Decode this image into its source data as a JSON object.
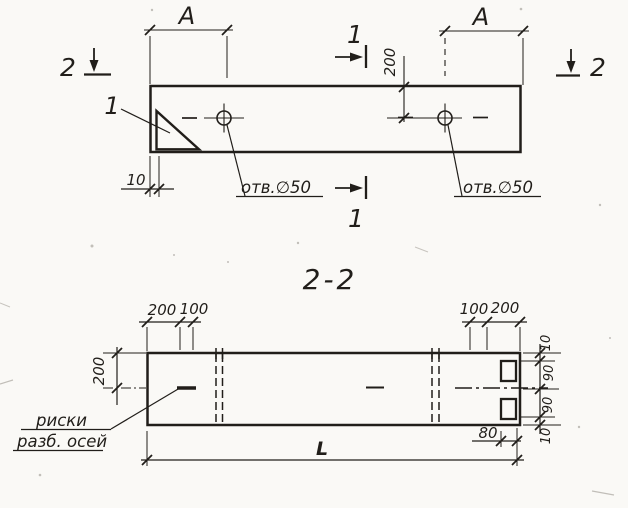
{
  "palette": {
    "paper": "#faf9f6",
    "ink": "#211e1a"
  },
  "plan_view": {
    "span_label_left": "А",
    "span_label_right": "А",
    "detail_mark": "1",
    "section_mark_1_top": "1",
    "section_mark_1_bottom": "1",
    "section_mark_2_left": "2",
    "section_mark_2_right": "2",
    "dim_axis_offset": "200",
    "dim_end_offset": "10",
    "hole_note_left": "отв.∅50",
    "hole_note_right": "отв.∅50"
  },
  "section_view": {
    "title": "2-2",
    "dims_top_left": [
      "200",
      "100"
    ],
    "dims_top_right": [
      "100",
      "200"
    ],
    "dim_side": "200",
    "dims_right": [
      "10",
      "90",
      "90",
      "10"
    ],
    "dim_notch": "80",
    "dim_length": "L",
    "note_line1": "риски",
    "note_line2": "разб. осей"
  }
}
